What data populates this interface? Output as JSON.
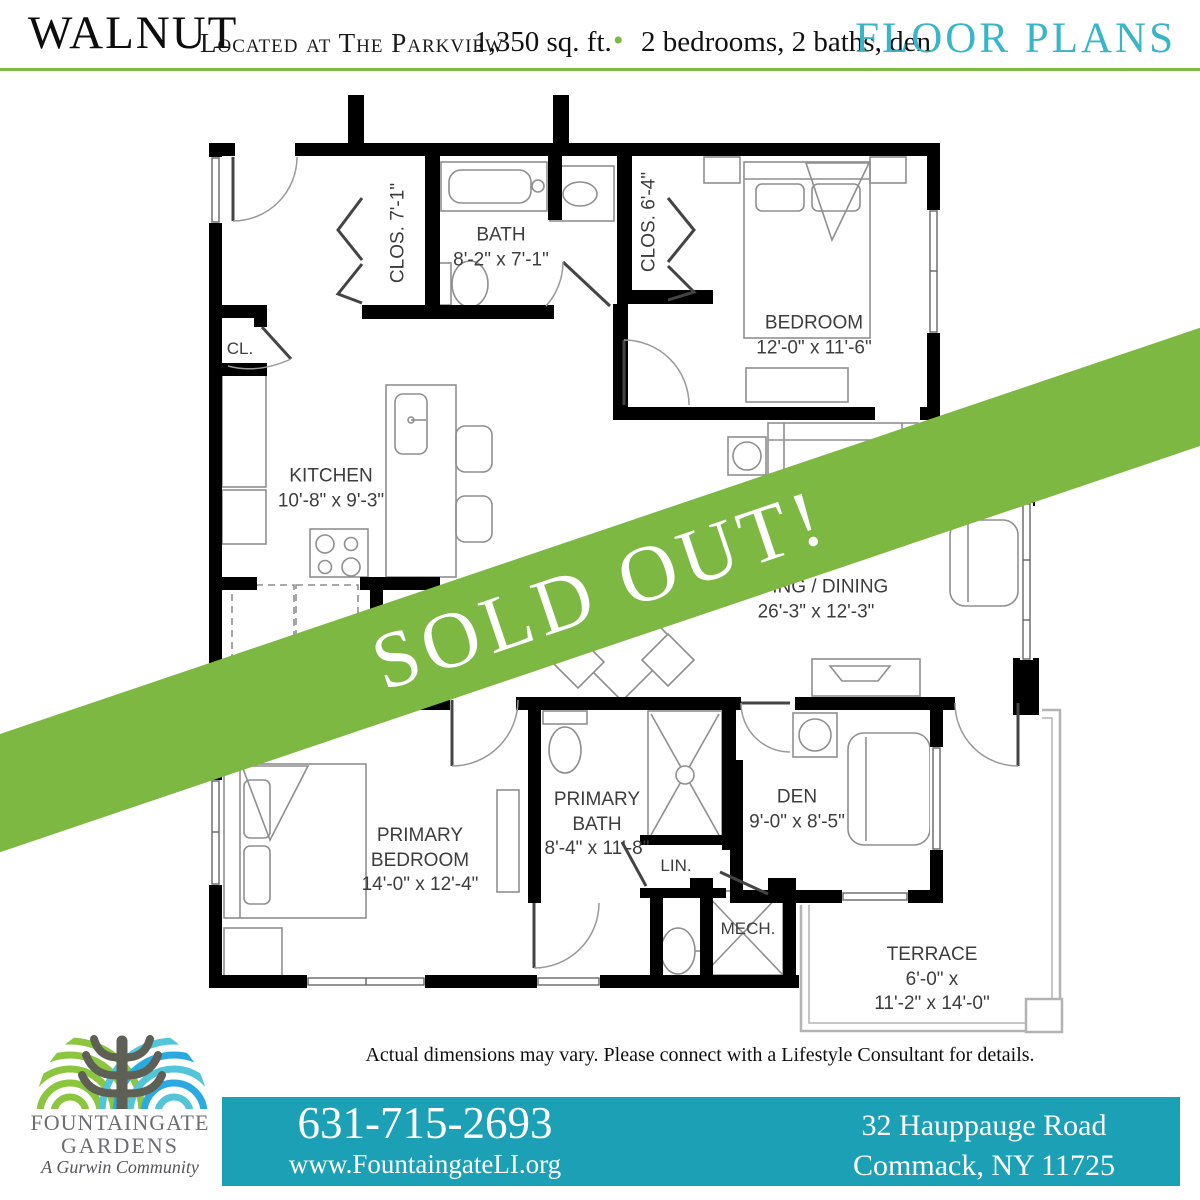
{
  "header": {
    "title": "WALNUT",
    "subtitle": "Located at The Parkview",
    "sqft": "1,350 sq. ft.",
    "bullet": "•",
    "features": "2 bedrooms, 2 baths, den",
    "page_label": "FLOOR PLANS"
  },
  "banner": {
    "text": "SOLD OUT!"
  },
  "rooms": {
    "clos1": {
      "name": "CLOS. 7'-1\""
    },
    "bath": {
      "name": "BATH",
      "dims": "8'-2\" x 7'-1\""
    },
    "clos2": {
      "name": "CLOS. 6'-4\""
    },
    "bedroom": {
      "name": "BEDROOM",
      "dims": "12'-0\" x 11'-6\""
    },
    "cl": {
      "name": "CL."
    },
    "kitchen": {
      "name": "KITCHEN",
      "dims": "10'-8\" x 9'-3\""
    },
    "living": {
      "name": "LIVING / DINING",
      "dims": "26'-3\" x 12'-3\""
    },
    "primary_bedroom": {
      "line1": "PRIMARY",
      "line2": "BEDROOM",
      "dims": "14'-0\" x 12'-4\""
    },
    "primary_bath": {
      "line1": "PRIMARY",
      "line2": "BATH",
      "dims": "8'-4\" x 11'-8\""
    },
    "lin": {
      "name": "LIN."
    },
    "mech": {
      "name": "MECH."
    },
    "den": {
      "name": "DEN",
      "dims": "9'-0\" x 8'-5\""
    },
    "terrace": {
      "name": "TERRACE",
      "dims_line1": "6'-0\" x",
      "dims_line2": "11'-2\" x 14'-0\""
    }
  },
  "disclaimer": "Actual dimensions may vary. Please connect with a Lifestyle Consultant for details.",
  "footer": {
    "logo_line1": "FOUNTAINGATE",
    "logo_line2": "GARDENS",
    "logo_tagline": "A Gurwin Community",
    "phone": "631-715-2693",
    "website": "www.FountaingateLI.org",
    "address_line1": "32 Hauppauge Road",
    "address_line2": "Commack, NY 11725"
  },
  "colors": {
    "accent_green": "#7CB842",
    "contact_bar_teal": "#1CA0B5",
    "floor_plans_teal": "#38B6C9",
    "logo_green": "#8CC63F",
    "logo_blue": "#2BAAE2",
    "logo_teal": "#52C6D8",
    "logo_gray": "#6D6E71",
    "wall_black": "#000000"
  }
}
